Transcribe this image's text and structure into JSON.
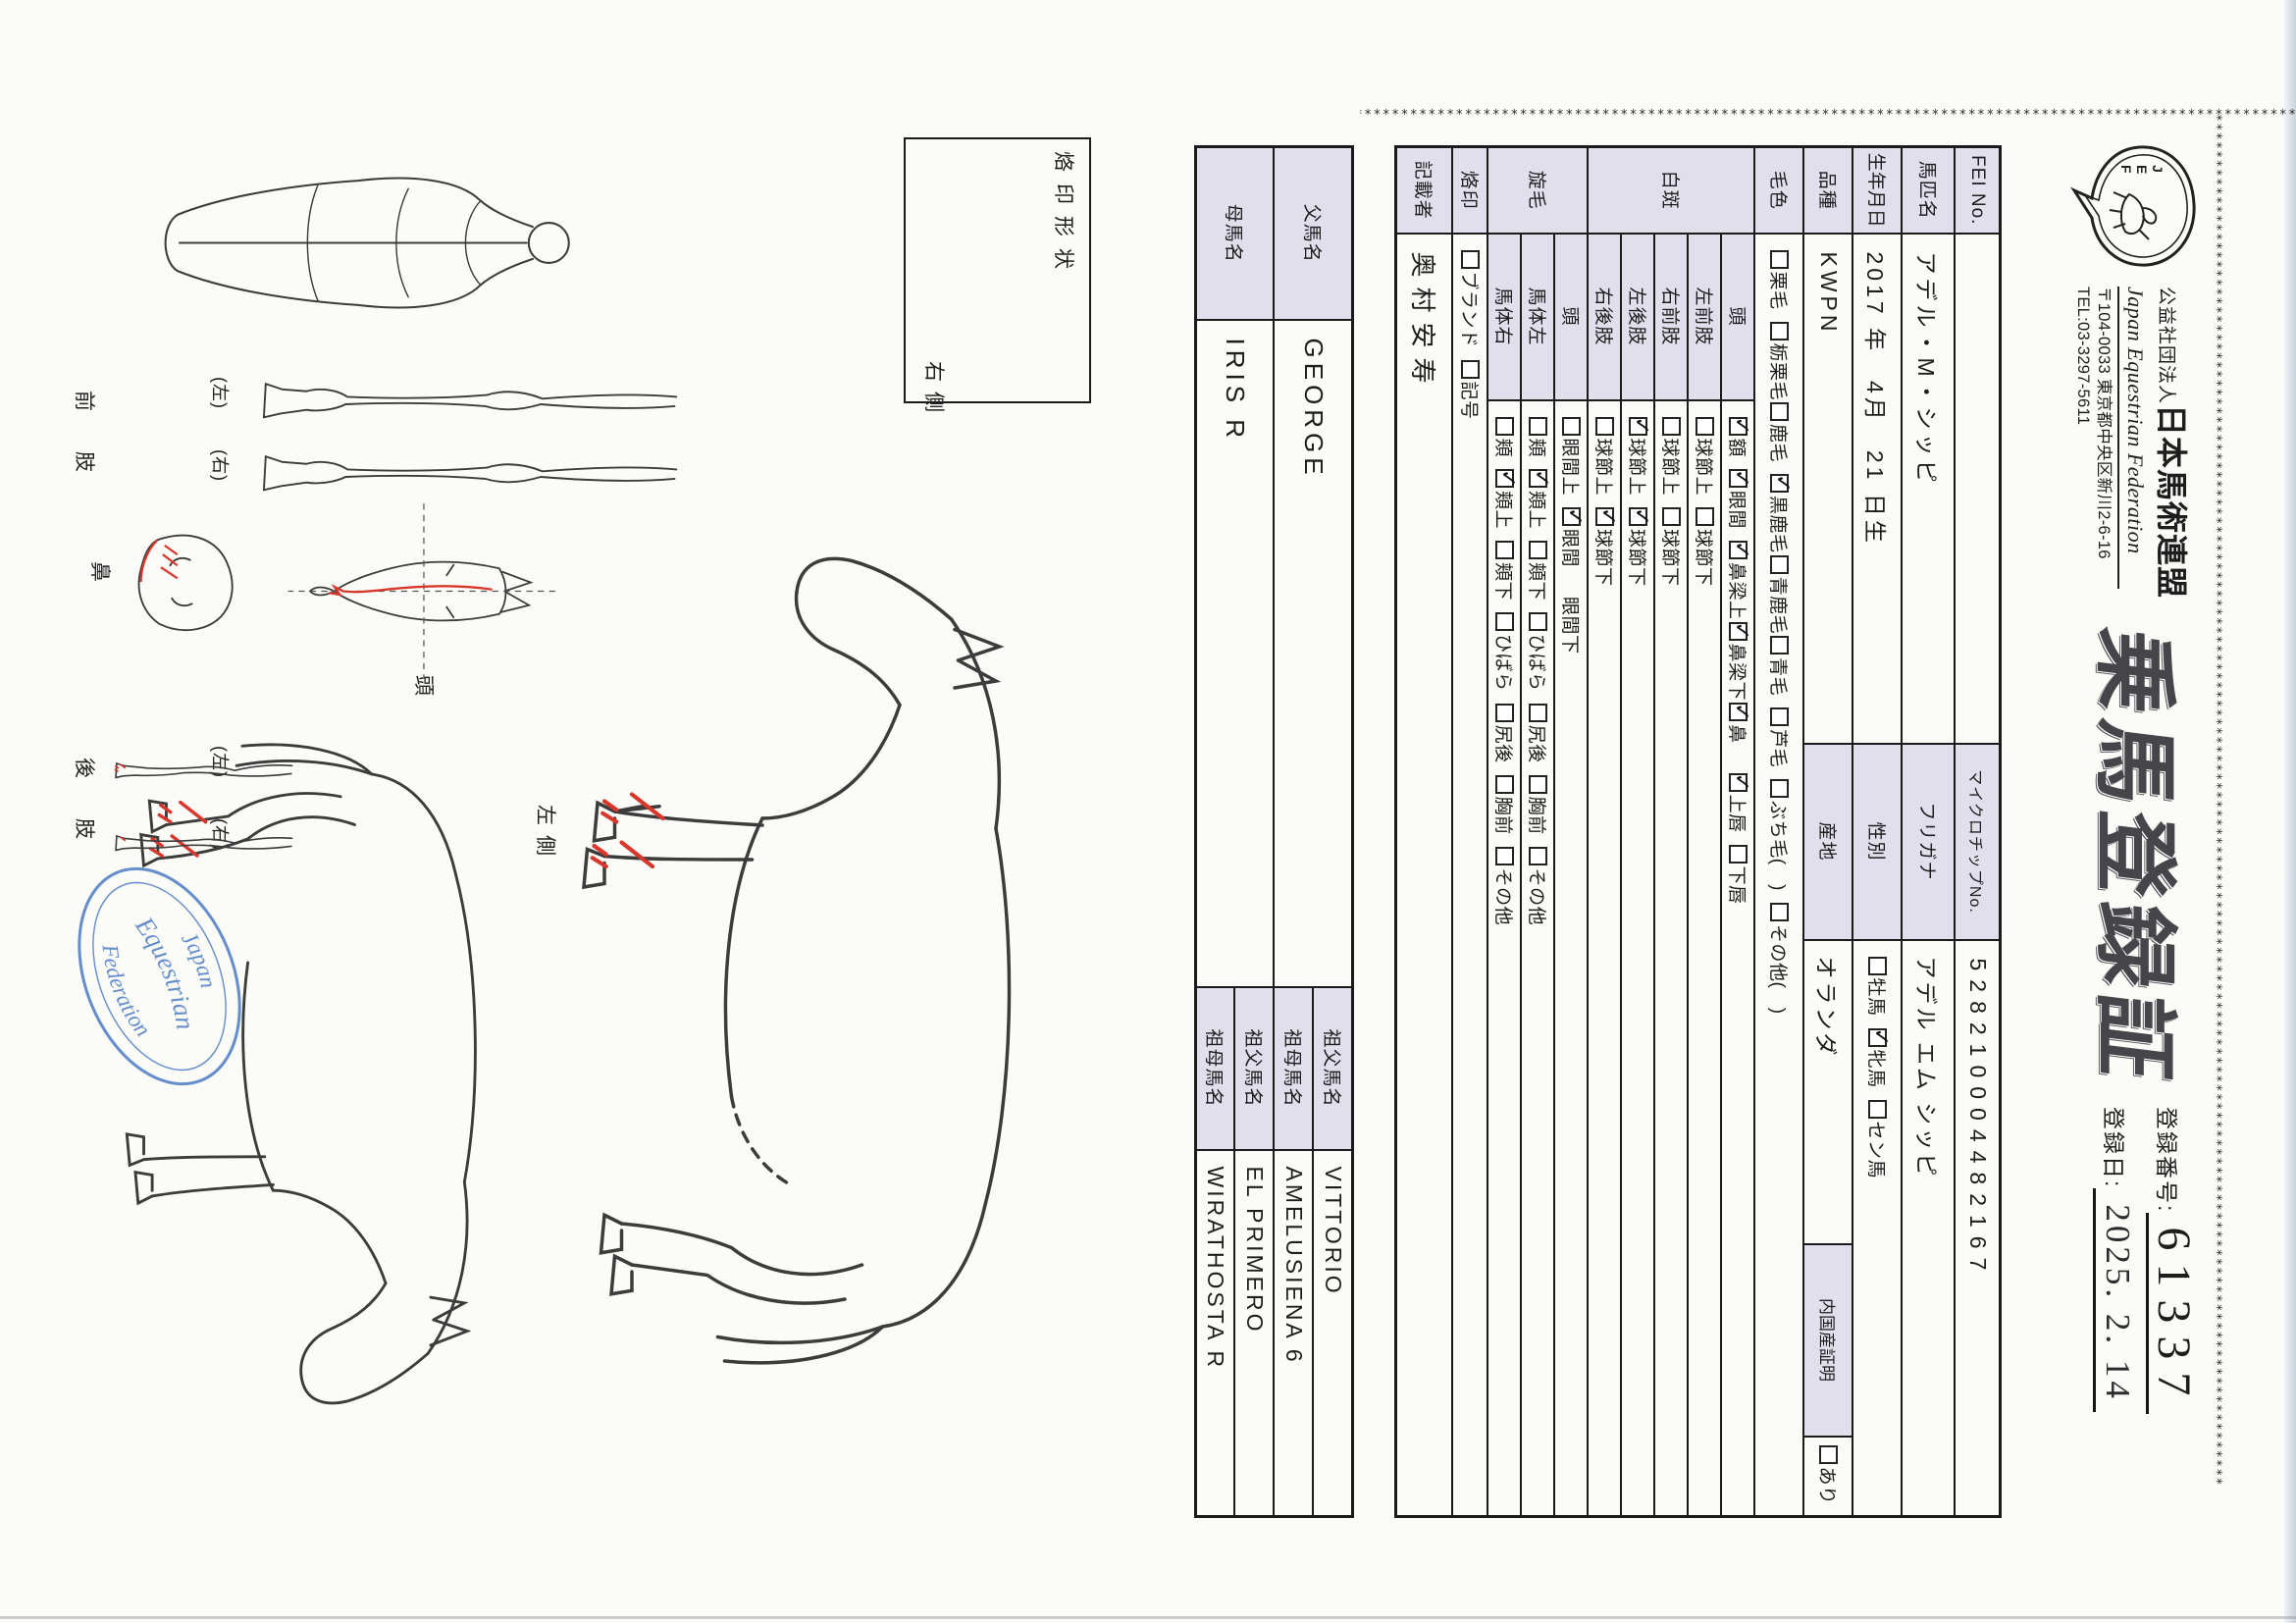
{
  "header": {
    "org_prefix": "公益社団法人",
    "org_name": "日本馬術連盟",
    "org_en": "Japan Equestrian Federation",
    "address": "〒104-0033 東京都中央区新川2-6-16",
    "tel": "TEL:03-3297-5611",
    "title": "乗馬登録証",
    "logo": "JEF",
    "reg_no_label": "登録番号:",
    "reg_no": "61337",
    "reg_date_label": "登録日:",
    "reg_date": "2025. 2. 14"
  },
  "table": {
    "fei": {
      "label": "FEI No.",
      "value": "",
      "mid_label": "マイクロチップNo.",
      "mid_value": "528210004482167"
    },
    "name": {
      "label": "馬匹名",
      "value": "アデル・M・シッピ",
      "mid_label": "フリガナ",
      "mid_value": "アデル エム シッピ"
    },
    "birth": {
      "label": "生年月日",
      "value": "2017 年　4月　21 日生",
      "mid_label": "性別",
      "sex_options": [
        {
          "t": "牡馬",
          "c": false
        },
        {
          "t": "牝馬",
          "c": true
        },
        {
          "t": "セン馬",
          "c": false
        }
      ]
    },
    "breed": {
      "label": "品種",
      "value": "KWPN",
      "mid_label": "産地",
      "mid_value": "オランダ",
      "domestic_label": "内国産証明",
      "domestic_options": [
        {
          "t": "あり",
          "c": false
        }
      ]
    },
    "coat": {
      "label": "毛色",
      "items": [
        {
          "t": "栗毛",
          "c": false
        },
        {
          "t": "栃栗毛",
          "c": false
        },
        {
          "t": "鹿毛",
          "c": false,
          "tight": true
        },
        {
          "t": "黒鹿毛",
          "c": true
        },
        {
          "t": "青鹿毛",
          "c": false,
          "tight": true
        },
        {
          "t": "青毛",
          "c": false,
          "tight": true
        },
        {
          "t": "芦毛",
          "c": false
        },
        {
          "t": "ぶち毛(　)",
          "c": false
        },
        {
          "t": "その他(　)",
          "c": false
        }
      ]
    },
    "white_markings": {
      "label": "白斑",
      "subrows": [
        {
          "label": "頭",
          "items": [
            {
              "t": "額",
              "c": true
            },
            {
              "t": "眼間",
              "c": true
            },
            {
              "t": "鼻梁上",
              "c": true
            },
            {
              "t": "鼻梁下",
              "c": true,
              "tight": true
            },
            {
              "t": "鼻",
              "c": true,
              "tight": true
            },
            {
              "t": "上唇",
              "c": true,
              "gap": true
            },
            {
              "t": "下唇",
              "c": false
            }
          ]
        },
        {
          "label": "左前肢",
          "items": [
            {
              "t": "球節上",
              "c": false
            },
            {
              "t": "球節下",
              "c": false
            }
          ]
        },
        {
          "label": "右前肢",
          "items": [
            {
              "t": "球節上",
              "c": false
            },
            {
              "t": "球節下",
              "c": false
            }
          ]
        },
        {
          "label": "左後肢",
          "items": [
            {
              "t": "球節上",
              "c": true
            },
            {
              "t": "球節下",
              "c": true
            }
          ]
        },
        {
          "label": "右後肢",
          "items": [
            {
              "t": "球節上",
              "c": false
            },
            {
              "t": "球節下",
              "c": true
            }
          ]
        }
      ]
    },
    "whorls": {
      "label": "旋毛",
      "subrows": [
        {
          "label": "頭",
          "items": [
            {
              "t": "眼間上",
              "c": false
            },
            {
              "t": "眼間",
              "c": true
            },
            {
              "t": "眼間下",
              "nobox": true,
              "gap": true
            }
          ]
        },
        {
          "label": "馬体左",
          "items": [
            {
              "t": "頬",
              "c": false
            },
            {
              "t": "頬上",
              "c": true
            },
            {
              "t": "頬下",
              "c": false
            },
            {
              "t": "ひばら",
              "c": false
            },
            {
              "t": "尻後",
              "c": false
            },
            {
              "t": "胸前",
              "c": false
            },
            {
              "t": "その他",
              "c": false
            }
          ]
        },
        {
          "label": "馬体右",
          "items": [
            {
              "t": "頬",
              "c": false
            },
            {
              "t": "頬上",
              "c": true
            },
            {
              "t": "頬下",
              "c": false
            },
            {
              "t": "ひばら",
              "c": false
            },
            {
              "t": "尻後",
              "c": false
            },
            {
              "t": "胸前",
              "c": false
            },
            {
              "t": "その他",
              "c": false
            }
          ]
        }
      ]
    },
    "brand": {
      "label": "烙印",
      "items": [
        {
          "t": "ブランド",
          "c": false
        },
        {
          "t": "記号",
          "c": false
        }
      ]
    },
    "recorder": {
      "label": "記載者",
      "value": "奥村安寿"
    }
  },
  "pedigree": {
    "sire": {
      "label": "父馬名",
      "value": "GEORGE",
      "gsire_label": "祖父馬名",
      "gsire": "VITTORIO",
      "gdam_label": "祖母馬名",
      "gdam": "AMELUSIENA 6"
    },
    "dam": {
      "label": "母馬名",
      "value": "IRIS R",
      "gsire_label": "祖父馬名",
      "gsire": "EL PRIMERO",
      "gdam_label": "祖母馬名",
      "gdam": "WIRATHOSTA R"
    }
  },
  "diagram": {
    "brand_shape_label": "烙印形状",
    "right_side": "右側",
    "left_side": "左側",
    "head": "頭",
    "nose": "鼻",
    "front_limbs": "前　肢",
    "hind_limbs": "後　肢",
    "left_paren": "(左)",
    "right_paren": "(右)",
    "stamp_line1": "Japan",
    "stamp_line2": "Equestrian",
    "stamp_line3": "Federation"
  },
  "colors": {
    "shade": "#e2dfed",
    "accent_red": "#d8372c",
    "stamp_blue": "#4677c4",
    "ink": "#1b1b1b"
  }
}
